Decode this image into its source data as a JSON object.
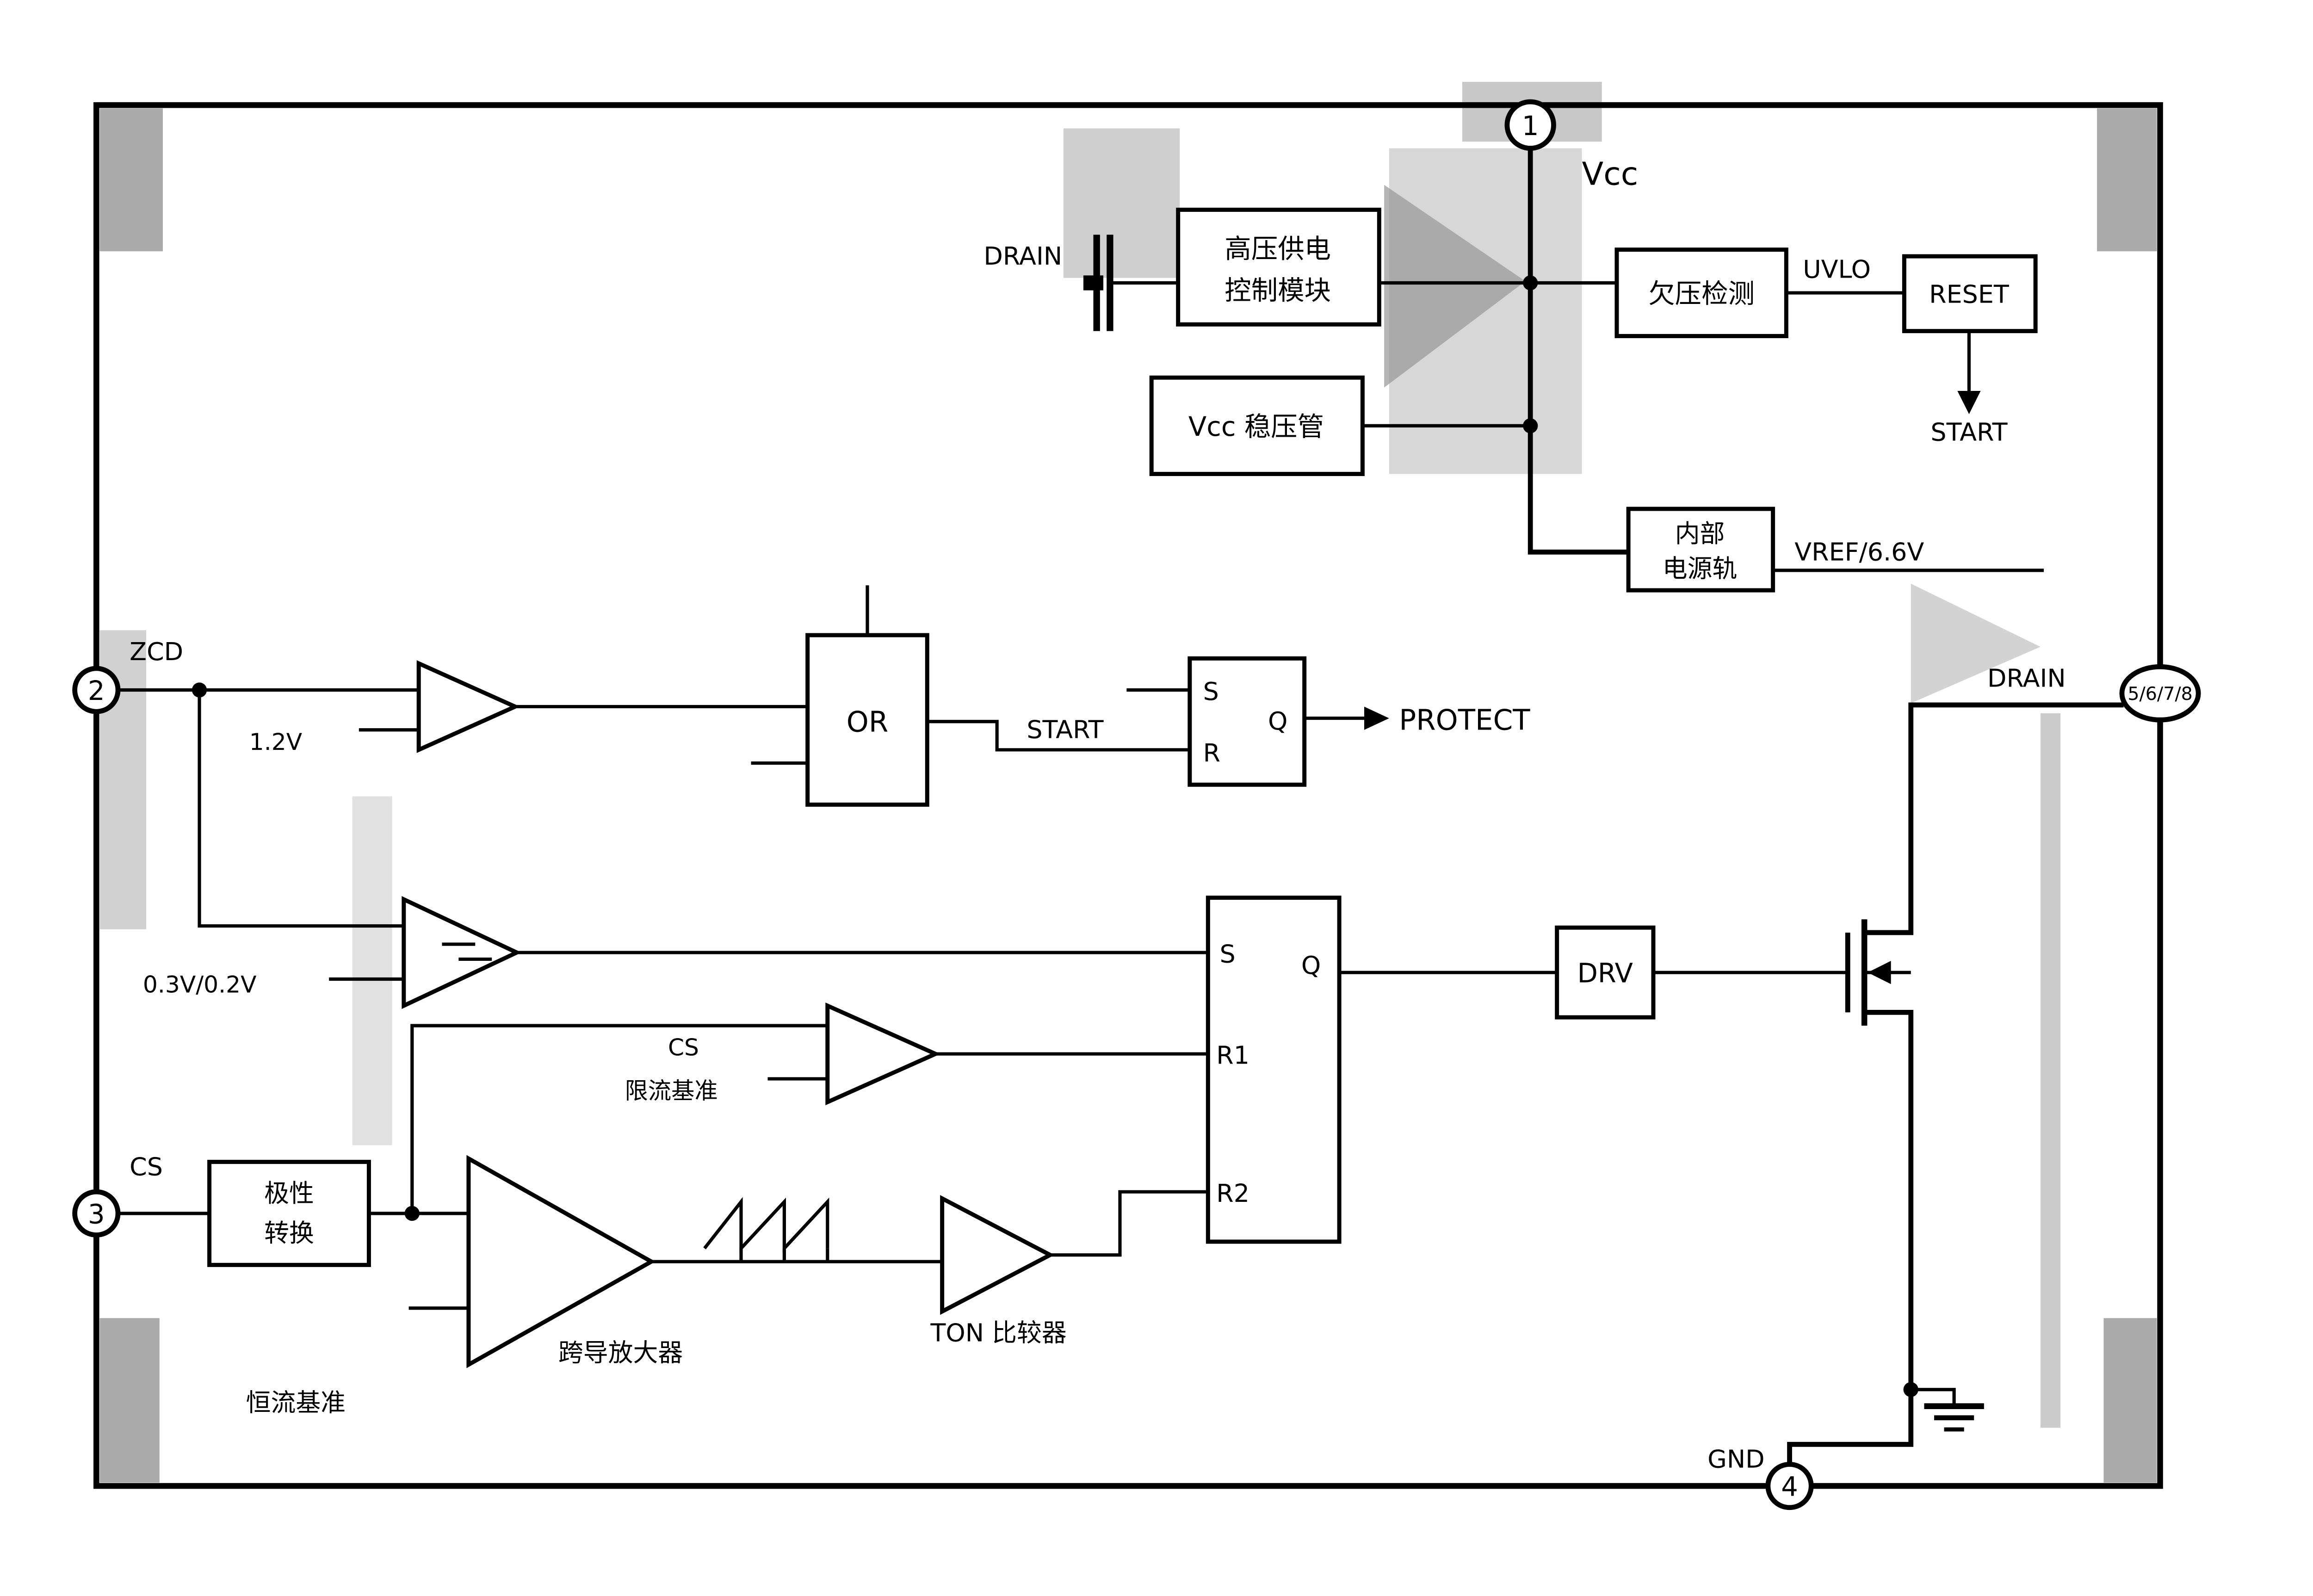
{
  "diagram": {
    "pins": {
      "p1": "1",
      "p2": "2",
      "p3": "3",
      "p4": "4",
      "p5678": "5/6/7/8"
    },
    "pin_labels": {
      "vcc": "Vcc",
      "zcd": "ZCD",
      "cs": "CS",
      "gnd": "GND",
      "drain_top": "DRAIN",
      "drain_right": "DRAIN"
    },
    "blocks": {
      "hv_supply_line1": "高压供电",
      "hv_supply_line2": "控制模块",
      "vcc_regulator": "Vcc 稳压管",
      "uv_detect": "欠压检测",
      "reset": "RESET",
      "internal_rail_line1": "内部",
      "internal_rail_line2": "电源轨",
      "polarity_line1": "极性",
      "polarity_line2": "转换",
      "or_gate": "OR",
      "drv": "DRV"
    },
    "latch_protect": {
      "s": "S",
      "r": "R",
      "q": "Q"
    },
    "latch_main": {
      "s": "S",
      "r1": "R1",
      "r2": "R2",
      "q": "Q"
    },
    "signals": {
      "uvlo": "UVLO",
      "start_top": "START",
      "vref": "VREF/6.6V",
      "start_mid": "START",
      "protect": "PROTECT",
      "ref_12": "1.2V",
      "ref_0302": "0.3V/0.2V",
      "cs_sense": "CS",
      "ilim_ref": "限流基准",
      "cc_ref": "恒流基准",
      "ota": "跨导放大器",
      "ton": "TON 比较器"
    }
  },
  "colors": {
    "line": "#000000",
    "bg": "#ffffff",
    "artifact": "#a6a6a6"
  }
}
